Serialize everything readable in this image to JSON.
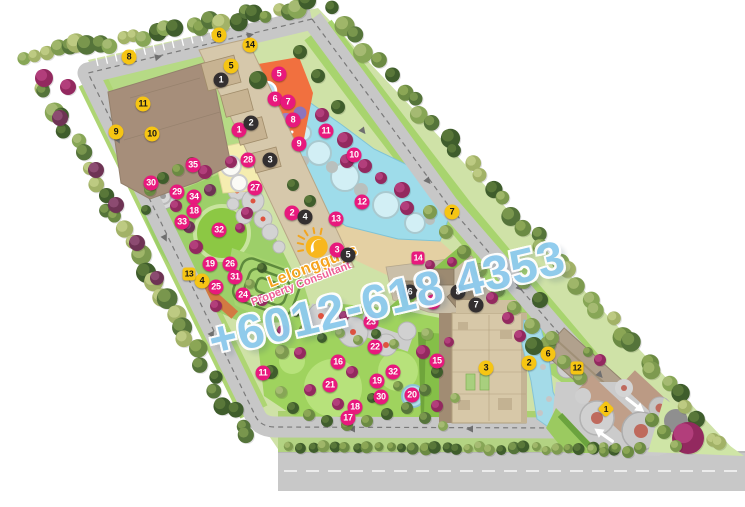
{
  "watermark": {
    "brand": "Lelongguys",
    "tagline": "Property Consultant",
    "phone": "+6012-618 4353"
  },
  "colors": {
    "marker_pink": "#e8197d",
    "marker_yellow": "#f6c513",
    "marker_black": "#332f30",
    "watermark_brand": "#f6a41f",
    "watermark_tagline": "#ee5f95",
    "watermark_phone": "#8ecbee"
  },
  "markers": {
    "yellow_circles": [
      {
        "n": "6",
        "x": 219,
        "y": 35
      },
      {
        "n": "14",
        "x": 250,
        "y": 45
      },
      {
        "n": "8",
        "x": 129,
        "y": 57
      },
      {
        "n": "5",
        "x": 231,
        "y": 66
      },
      {
        "n": "11",
        "x": 143,
        "y": 104
      },
      {
        "n": "9",
        "x": 116,
        "y": 132
      },
      {
        "n": "10",
        "x": 152,
        "y": 134
      },
      {
        "n": "7",
        "x": 452,
        "y": 212
      },
      {
        "n": "4",
        "x": 202,
        "y": 281
      },
      {
        "n": "2",
        "x": 529,
        "y": 363
      },
      {
        "n": "6",
        "x": 548,
        "y": 354
      },
      {
        "n": "3",
        "x": 486,
        "y": 368
      }
    ],
    "yellow_squares": [
      {
        "n": "13",
        "x": 189,
        "y": 274
      },
      {
        "n": "12",
        "x": 577,
        "y": 368
      }
    ],
    "yellow_diamonds": [
      {
        "n": "1",
        "x": 606,
        "y": 409
      }
    ],
    "black_circles": [
      {
        "n": "1",
        "x": 221,
        "y": 80
      },
      {
        "n": "2",
        "x": 251,
        "y": 123
      },
      {
        "n": "3",
        "x": 270,
        "y": 160
      },
      {
        "n": "4",
        "x": 305,
        "y": 217
      },
      {
        "n": "5",
        "x": 348,
        "y": 255
      },
      {
        "n": "6",
        "x": 410,
        "y": 292
      },
      {
        "n": "7",
        "x": 476,
        "y": 305
      },
      {
        "n": "8",
        "x": 458,
        "y": 292
      }
    ],
    "pink_circles": [
      {
        "n": "5",
        "x": 279,
        "y": 74
      },
      {
        "n": "6",
        "x": 275,
        "y": 99
      },
      {
        "n": "7",
        "x": 288,
        "y": 102
      },
      {
        "n": "8",
        "x": 293,
        "y": 120
      },
      {
        "n": "1",
        "x": 239,
        "y": 130
      },
      {
        "n": "11",
        "x": 326,
        "y": 131
      },
      {
        "n": "9",
        "x": 299,
        "y": 144
      },
      {
        "n": "10",
        "x": 354,
        "y": 155
      },
      {
        "n": "28",
        "x": 248,
        "y": 160
      },
      {
        "n": "35",
        "x": 193,
        "y": 165
      },
      {
        "n": "30",
        "x": 151,
        "y": 183
      },
      {
        "n": "27",
        "x": 255,
        "y": 188
      },
      {
        "n": "29",
        "x": 177,
        "y": 192
      },
      {
        "n": "34",
        "x": 194,
        "y": 197
      },
      {
        "n": "12",
        "x": 362,
        "y": 202
      },
      {
        "n": "18",
        "x": 194,
        "y": 211
      },
      {
        "n": "2",
        "x": 292,
        "y": 213
      },
      {
        "n": "13",
        "x": 336,
        "y": 219
      },
      {
        "n": "33",
        "x": 182,
        "y": 222
      },
      {
        "n": "32",
        "x": 219,
        "y": 230
      },
      {
        "n": "3",
        "x": 337,
        "y": 250
      },
      {
        "n": "19",
        "x": 210,
        "y": 264
      },
      {
        "n": "26",
        "x": 230,
        "y": 264
      },
      {
        "n": "31",
        "x": 235,
        "y": 277
      },
      {
        "n": "25",
        "x": 216,
        "y": 287
      },
      {
        "n": "24",
        "x": 243,
        "y": 295
      },
      {
        "n": "4",
        "x": 433,
        "y": 302
      },
      {
        "n": "23",
        "x": 371,
        "y": 322
      },
      {
        "n": "22",
        "x": 375,
        "y": 347
      },
      {
        "n": "16",
        "x": 338,
        "y": 362
      },
      {
        "n": "15",
        "x": 437,
        "y": 361
      },
      {
        "n": "11",
        "x": 263,
        "y": 373
      },
      {
        "n": "32",
        "x": 393,
        "y": 372
      },
      {
        "n": "19",
        "x": 377,
        "y": 381
      },
      {
        "n": "21",
        "x": 330,
        "y": 385
      },
      {
        "n": "20",
        "x": 412,
        "y": 395
      },
      {
        "n": "30",
        "x": 381,
        "y": 397
      },
      {
        "n": "18",
        "x": 355,
        "y": 407
      },
      {
        "n": "17",
        "x": 348,
        "y": 418
      }
    ],
    "pink_squares": [
      {
        "n": "14",
        "x": 418,
        "y": 258
      }
    ]
  },
  "entrance_arrows": [
    {
      "x": 634,
      "y": 404,
      "angle": 38
    },
    {
      "x": 605,
      "y": 436,
      "angle": 215
    }
  ]
}
